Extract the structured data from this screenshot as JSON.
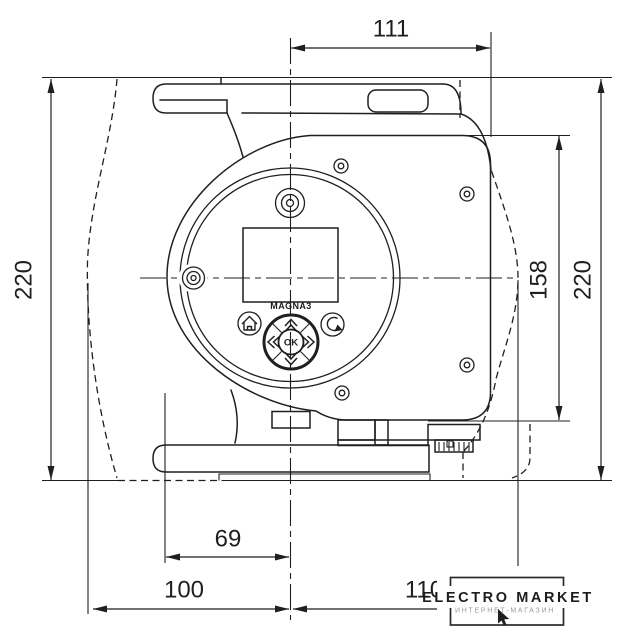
{
  "page": {
    "background": "#ffffff",
    "line_color": "#1f1f1f"
  },
  "dimensions": {
    "top_width_mm": "111",
    "overall_height_left_mm": "220",
    "body_height_mm": "158",
    "overall_height_right_mm": "220",
    "foot_offset_mm": "69",
    "center_to_left_mm": "100",
    "center_to_right_mm": "110"
  },
  "control_panel": {
    "brand_model": "MAGNA3",
    "ok_button": "OK"
  },
  "watermark": {
    "store_name": "ELECTRO MARKET",
    "store_tagline": "ИНТЕРНЕТ-МАГАЗИН"
  }
}
